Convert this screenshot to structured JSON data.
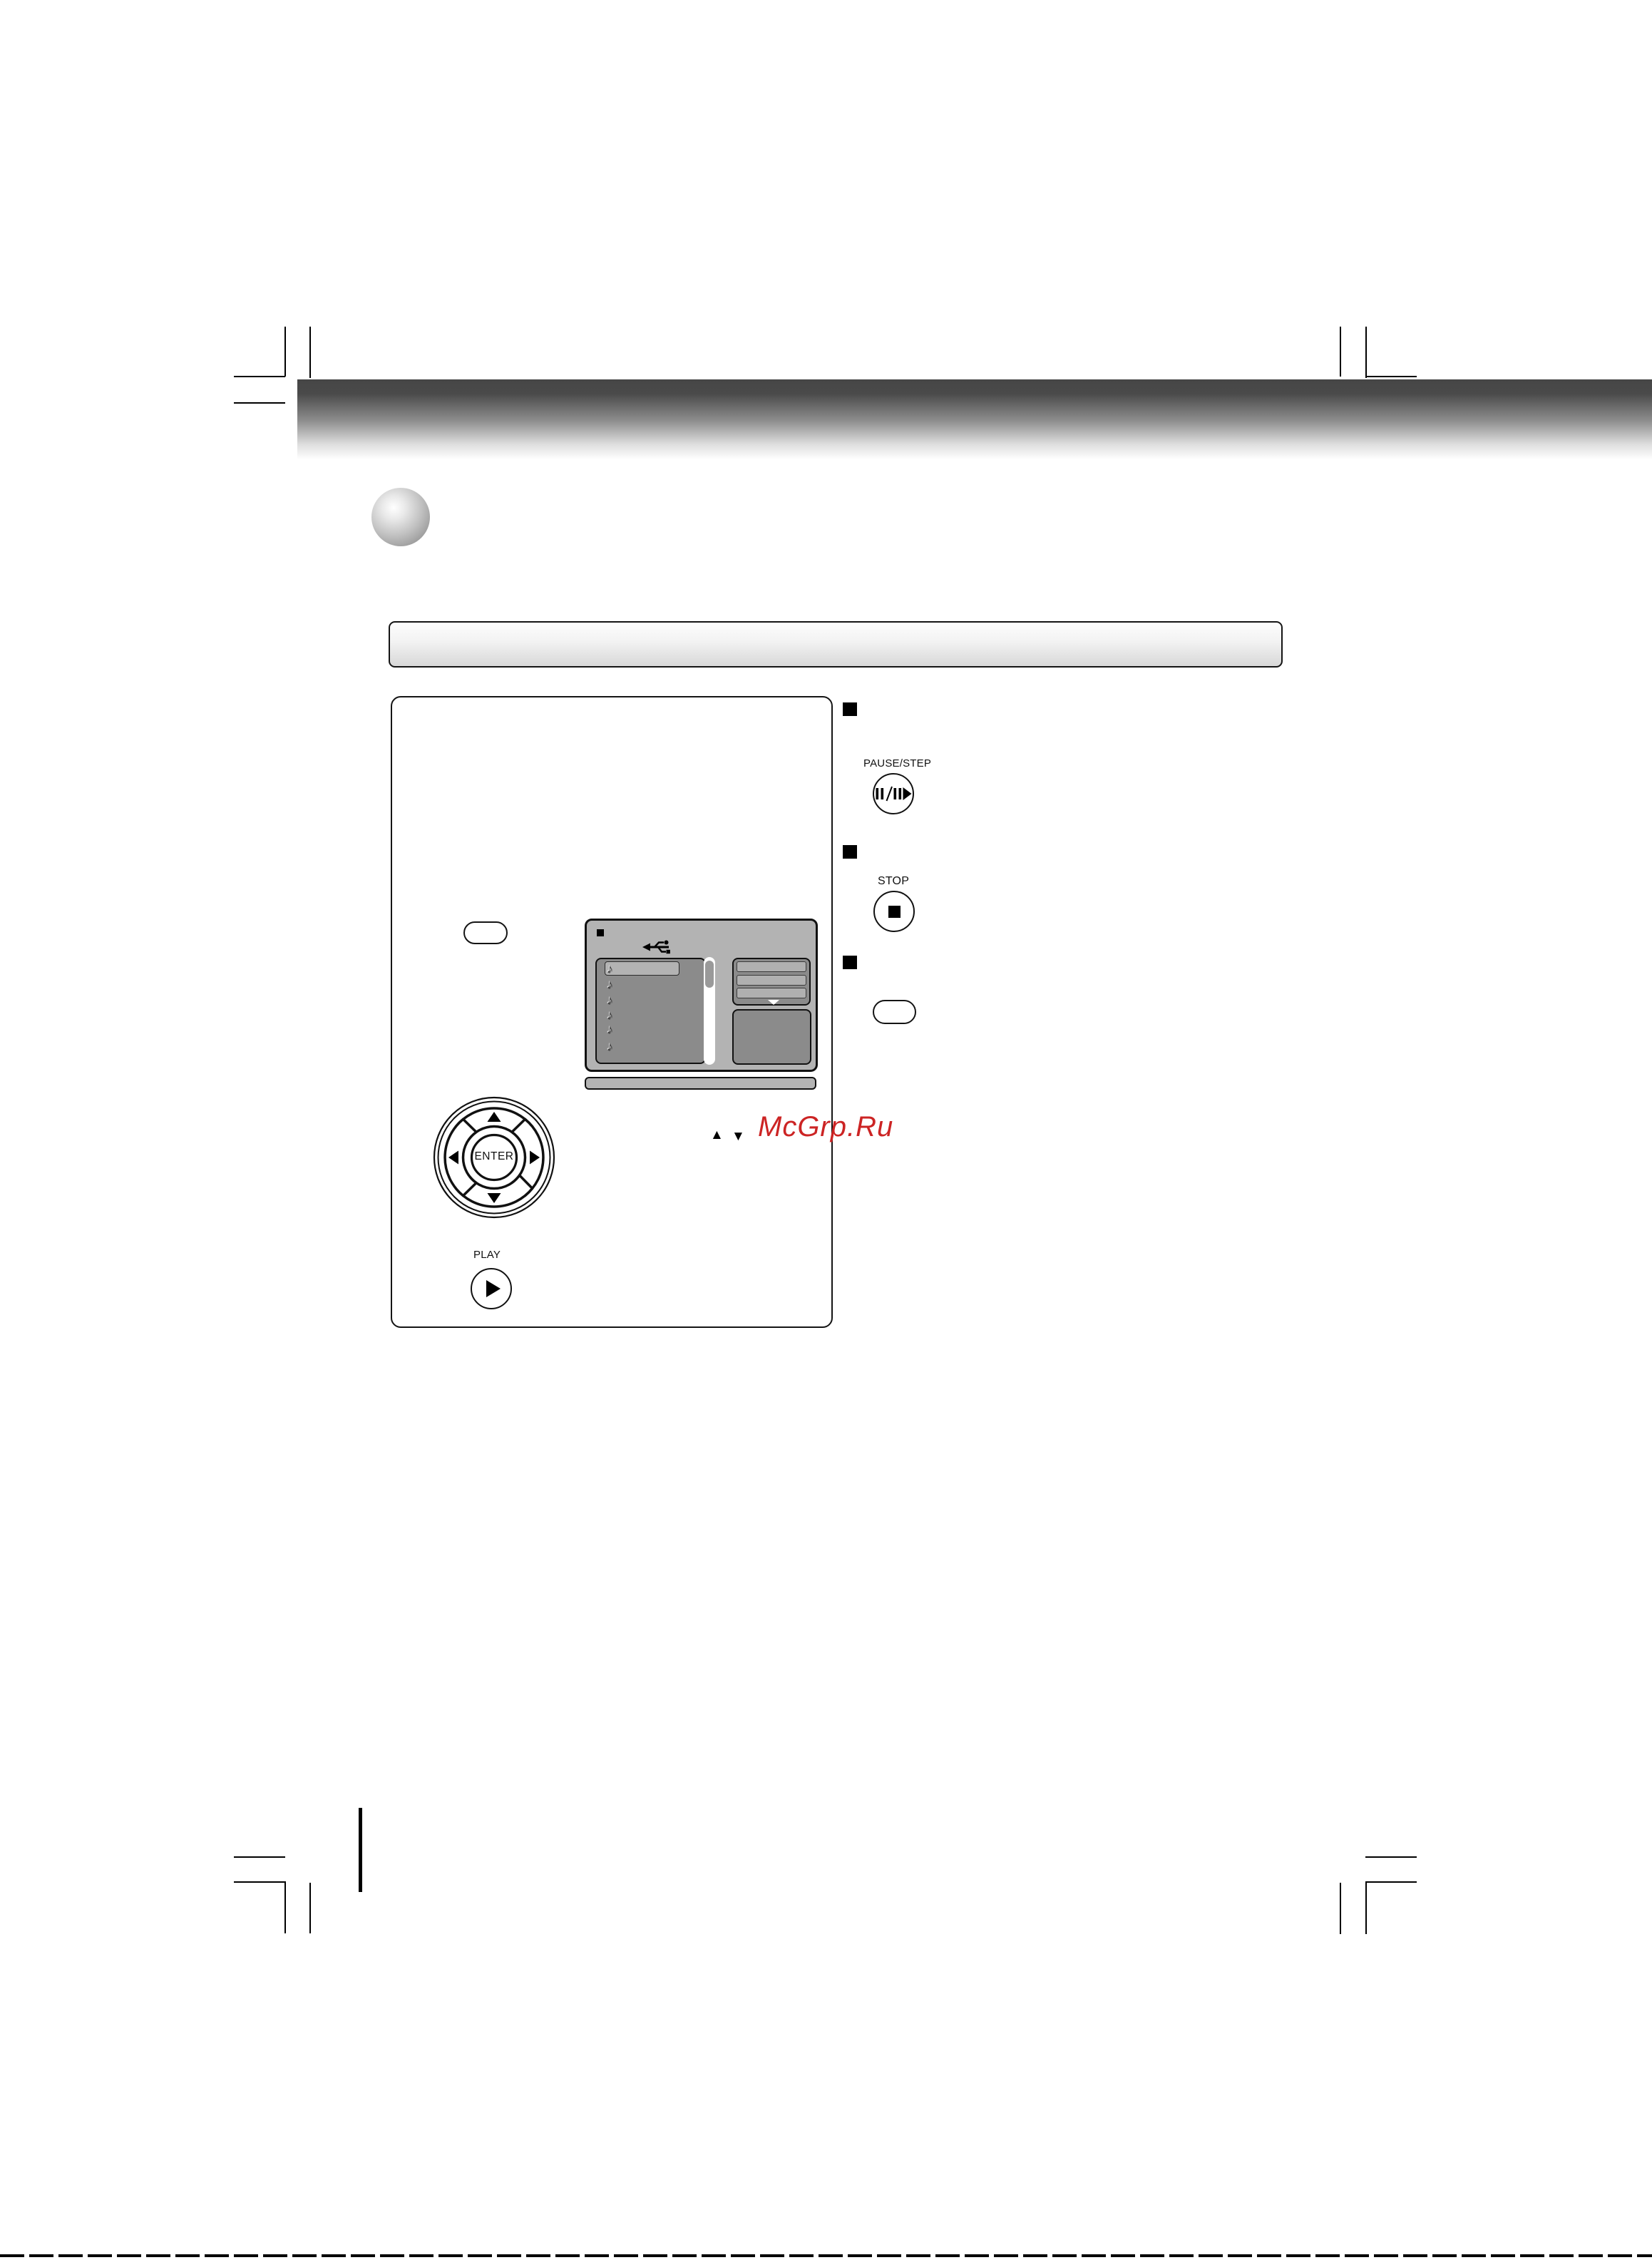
{
  "watermark": {
    "text": "McGrp.Ru",
    "color": "#cc2424"
  },
  "remote": {
    "pause_step_label": "PAUSE/STEP",
    "stop_label": "STOP",
    "enter_label": "ENTER",
    "play_label": "PLAY"
  },
  "symbols": {
    "up_triangle": "▲",
    "down_triangle": "▼"
  },
  "screen": {
    "note_glyph": "♪",
    "note_count": 6,
    "body_gray": "#b3b3b3",
    "panel_gray": "#8b8b8b"
  },
  "icons": [
    "pause-step-icon",
    "stop-icon",
    "play-icon",
    "usb-icon",
    "enter-dpad",
    "scrollbar",
    "menu-dropdown-triangle"
  ]
}
